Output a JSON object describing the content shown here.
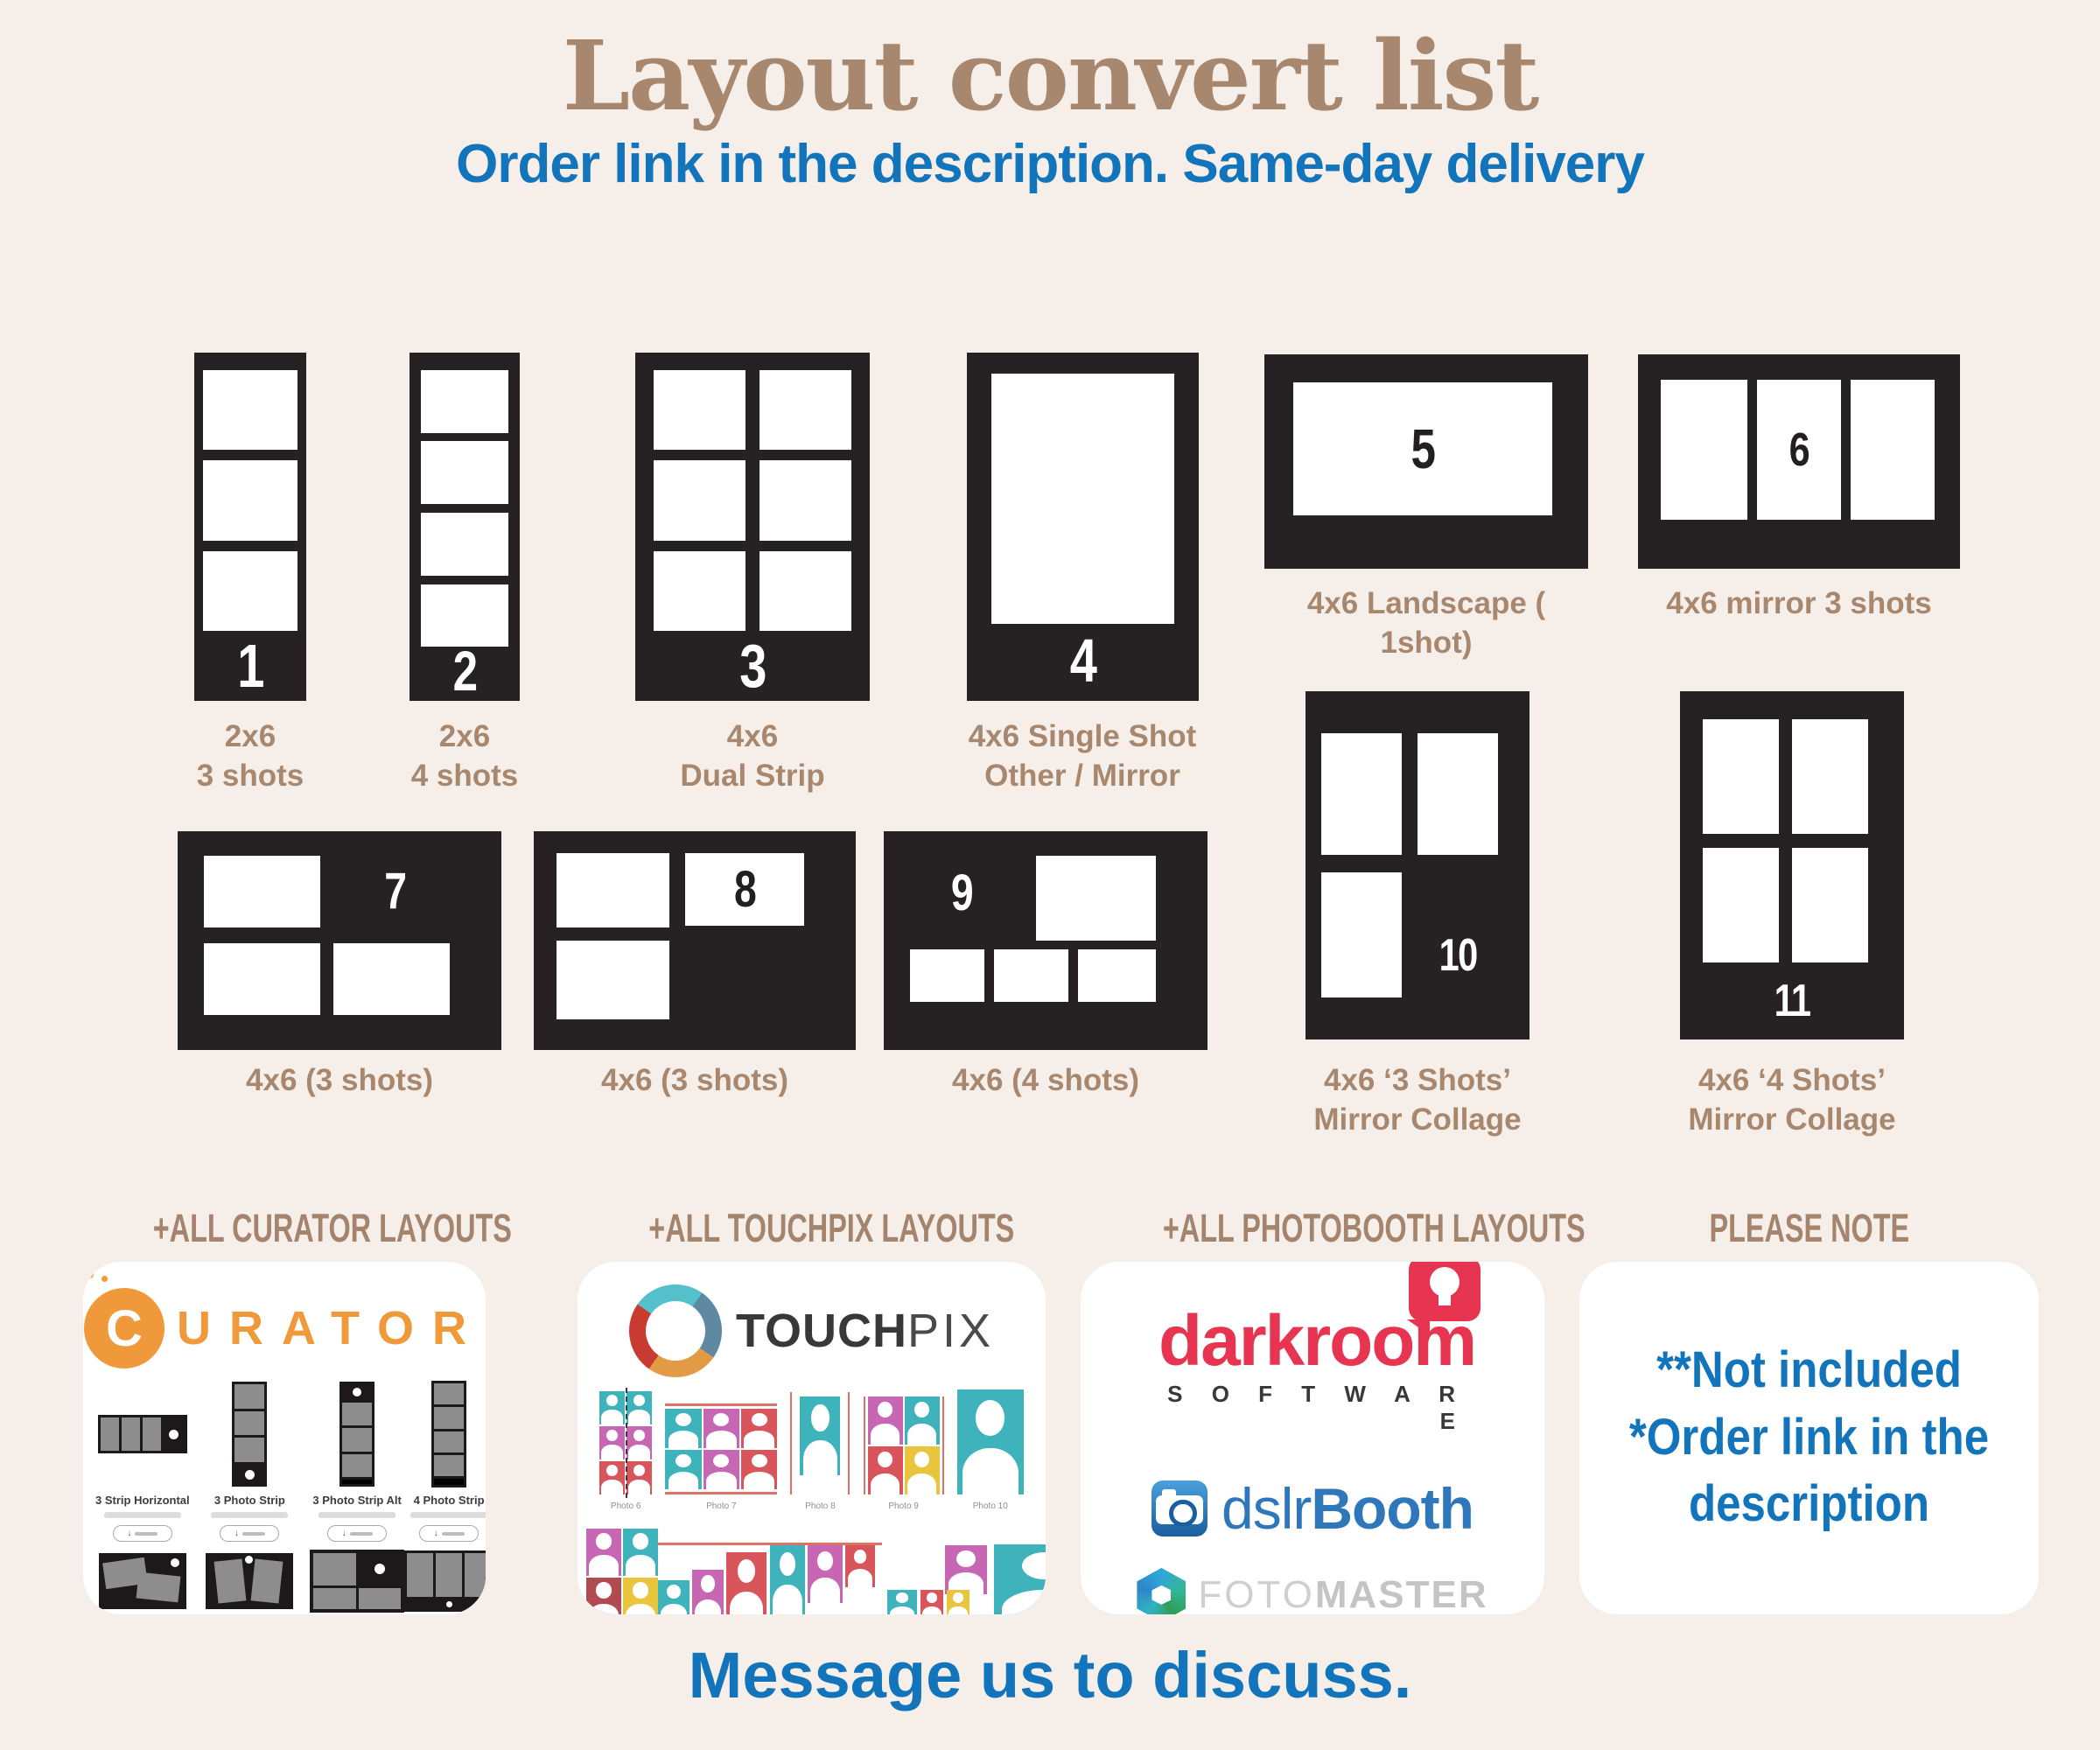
{
  "page": {
    "title": "Layout convert list",
    "subtitle": "Order link in the description. Same-day delivery",
    "footer": "Message us to discuss."
  },
  "colors": {
    "background": "#f6efe9",
    "accent_blue": "#1274bb",
    "label_brown": "#a8876f",
    "card_black": "#262122",
    "curator_orange": "#f0993a",
    "darkroom_red": "#e73450",
    "dslrbooth_blue": "#2e77bb",
    "touchpix_teal": "#3fb3bc",
    "touchpix_magenta": "#c767b3",
    "touchpix_red": "#d8565b",
    "touchpix_yellow": "#e9c53e"
  },
  "layouts": [
    {
      "num": "1",
      "label": [
        "2x6",
        "3 shots"
      ]
    },
    {
      "num": "2",
      "label": [
        "2x6",
        "4 shots"
      ]
    },
    {
      "num": "3",
      "label": [
        "4x6",
        "Dual Strip"
      ]
    },
    {
      "num": "4",
      "label": [
        "4x6 Single Shot",
        "Other / Mirror"
      ]
    },
    {
      "num": "5",
      "label": [
        "4x6 Landscape ( 1shot)"
      ]
    },
    {
      "num": "6",
      "label": [
        "4x6 mirror 3 shots"
      ]
    },
    {
      "num": "7",
      "label": [
        "4x6 (3 shots)"
      ]
    },
    {
      "num": "8",
      "label": [
        "4x6 (3 shots)"
      ]
    },
    {
      "num": "9",
      "label": [
        "4x6 (4 shots)"
      ]
    },
    {
      "num": "10",
      "label": [
        "4x6 ‘3 Shots’",
        "Mirror Collage"
      ]
    },
    {
      "num": "11",
      "label": [
        "4x6 ‘4 Shots’",
        "Mirror Collage"
      ]
    }
  ],
  "sections": {
    "curator": {
      "header": "+ALL CURATOR LAYOUTS",
      "logo_c": "C",
      "logo_rest": "URATOR",
      "thumbs": [
        "3 Strip Horizontal",
        "3 Photo Strip",
        "3 Photo Strip Alt",
        "4 Photo Strip",
        "2 Print Angled",
        "2 Print Angled Portrait",
        "3 Print",
        "3 Print Portrait"
      ]
    },
    "touchpix": {
      "header": "+ALL TOUCHPIX LAYOUTS",
      "logo_bold": "TOUCH",
      "logo_light": "PIX",
      "captions": [
        "Photo 6",
        "Photo 7",
        "Photo 8",
        "Photo 9",
        "Photo 10",
        "Photo 11",
        "Photo 12",
        "Photo 13",
        "Photo 14",
        "Photo 15"
      ]
    },
    "photobooth": {
      "header": "+ALL PHOTOBOOTH LAYOUTS",
      "darkroom": "darkroom",
      "darkroom_sub": "S O F T W A R E",
      "dslr_light": "dslr",
      "dslr_bold": "Booth",
      "foto_light": "FOTO",
      "foto_bold": "MASTER"
    },
    "note": {
      "header": "PLEASE NOTE",
      "lines": [
        "**Not included",
        "*Order link in the",
        "description"
      ]
    }
  }
}
